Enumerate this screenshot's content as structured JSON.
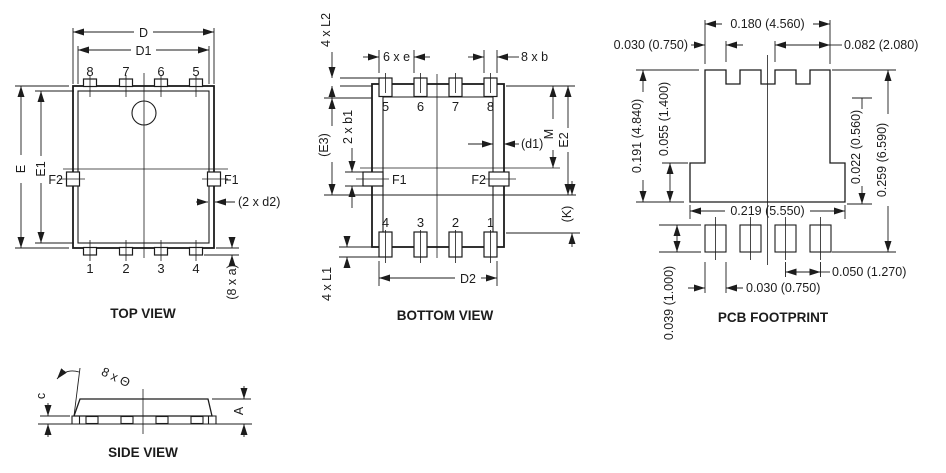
{
  "colors": {
    "ink": "#1c1c1c",
    "bg": "#ffffff"
  },
  "views": {
    "top": {
      "title": "TOP VIEW",
      "pins_top": [
        "8",
        "7",
        "6",
        "5"
      ],
      "pins_bottom": [
        "1",
        "2",
        "3",
        "4"
      ],
      "dims": {
        "D": "D",
        "D1": "D1",
        "E": "E",
        "E1": "E1",
        "F1": "F1",
        "F2": "F2",
        "d2": "(2 x d2)",
        "a": "(8 x a)"
      }
    },
    "bottom": {
      "title": "BOTTOM VIEW",
      "pins_top": [
        "5",
        "6",
        "7",
        "8"
      ],
      "pins_bottom": [
        "4",
        "3",
        "2",
        "1"
      ],
      "dims": {
        "L2": "4 x L2",
        "e": "6 x e",
        "b": "8 x b",
        "E3": "(E3)",
        "b1": "2 x b1",
        "d1": "(d1)",
        "M": "M",
        "E2": "E2",
        "F1": "F1",
        "F2": "F2",
        "K": "(K)",
        "D2": "D2",
        "L1": "4 x L1"
      }
    },
    "pcb": {
      "title": "PCB FOOTPRINT",
      "dims": {
        "top_width": "0.180 (4.560)",
        "tooth_width": "0.030 (0.750)",
        "top_right": "0.082 (2.080)",
        "pad_height": "0.191 (4.840)",
        "lower_height": "0.055 (1.400)",
        "edge_step": "0.022 (0.560)",
        "total_height": "0.259 (6.590)",
        "lower_width": "0.219 (5.550)",
        "pin_pad_height": "0.039 (1.000)",
        "pin_pad_width": "0.030 (0.750)",
        "pin_pitch": "0.050 (1.270)"
      }
    },
    "side": {
      "title": "SIDE VIEW",
      "dims": {
        "c": "c",
        "A": "A",
        "angle": "8 x Θ"
      }
    }
  }
}
